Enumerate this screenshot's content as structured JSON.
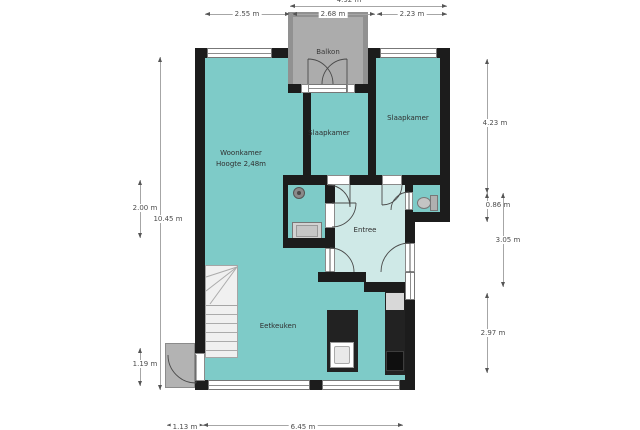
{
  "plan": {
    "rooms": {
      "balkon": {
        "label": "Balkon"
      },
      "woonkamer": {
        "label": "Woonkamer",
        "height_note": "Hoogte 2,48m"
      },
      "slaapkamer_mid": {
        "label": "Slaapkamer"
      },
      "slaapkamer_right": {
        "label": "Slaapkamer"
      },
      "entree": {
        "label": "Entree"
      },
      "eetkeuken": {
        "label": "Eetkeuken"
      }
    },
    "dims": {
      "top_total": "4.92 m",
      "top_left": "2.55 m",
      "top_mid": "2.68 m",
      "top_right": "2.23 m",
      "left_upper": "2.00 m",
      "left_total": "10.45 m",
      "left_lower": "1.19 m",
      "right_top": "4.23 m",
      "right_step": "0.86 m",
      "right_mid": "3.05 m",
      "right_bottom": "2.97 m",
      "bottom_left": "1.13 m",
      "bottom_mid": "6.45 m"
    },
    "colors": {
      "wall": "#1c1c1c",
      "room": "#7ecbc8",
      "hall": "#cfe9e7",
      "balcony": "#acacac",
      "balcony-wall": "#919191",
      "porch": "#b3b3b3"
    },
    "fixtures": [
      "stairs",
      "kitchen-island",
      "sink",
      "kitchen-counter",
      "stove",
      "fridge",
      "toilet",
      "shower-head",
      "washbasin",
      "bathtub-basin",
      "porch",
      "front-door"
    ]
  }
}
